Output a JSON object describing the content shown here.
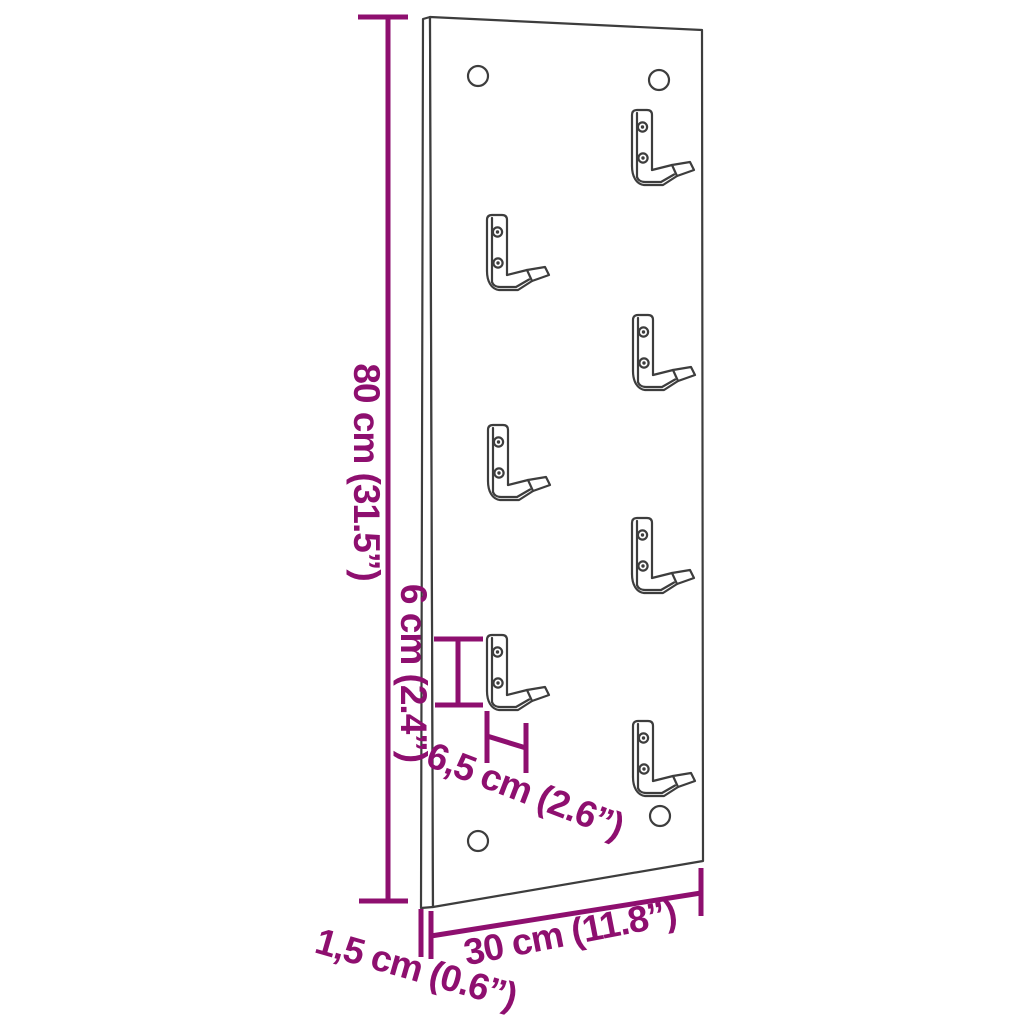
{
  "diagram": {
    "title": "wall-hook-panel-dimension-diagram",
    "colors": {
      "dimension": "#8e0f6f",
      "outline": "#3d3d3d",
      "background": "#ffffff"
    },
    "dimensions": {
      "height": "80 cm (31.5”)",
      "hook_gap": "6 cm (2.4”)",
      "hook_depth": "6,5 cm (2.6”)",
      "width": "30 cm (11.8”)",
      "thickness": "1,5 cm (0.6”)"
    },
    "counts": {
      "hooks": 7,
      "mounting_holes": 4
    }
  }
}
